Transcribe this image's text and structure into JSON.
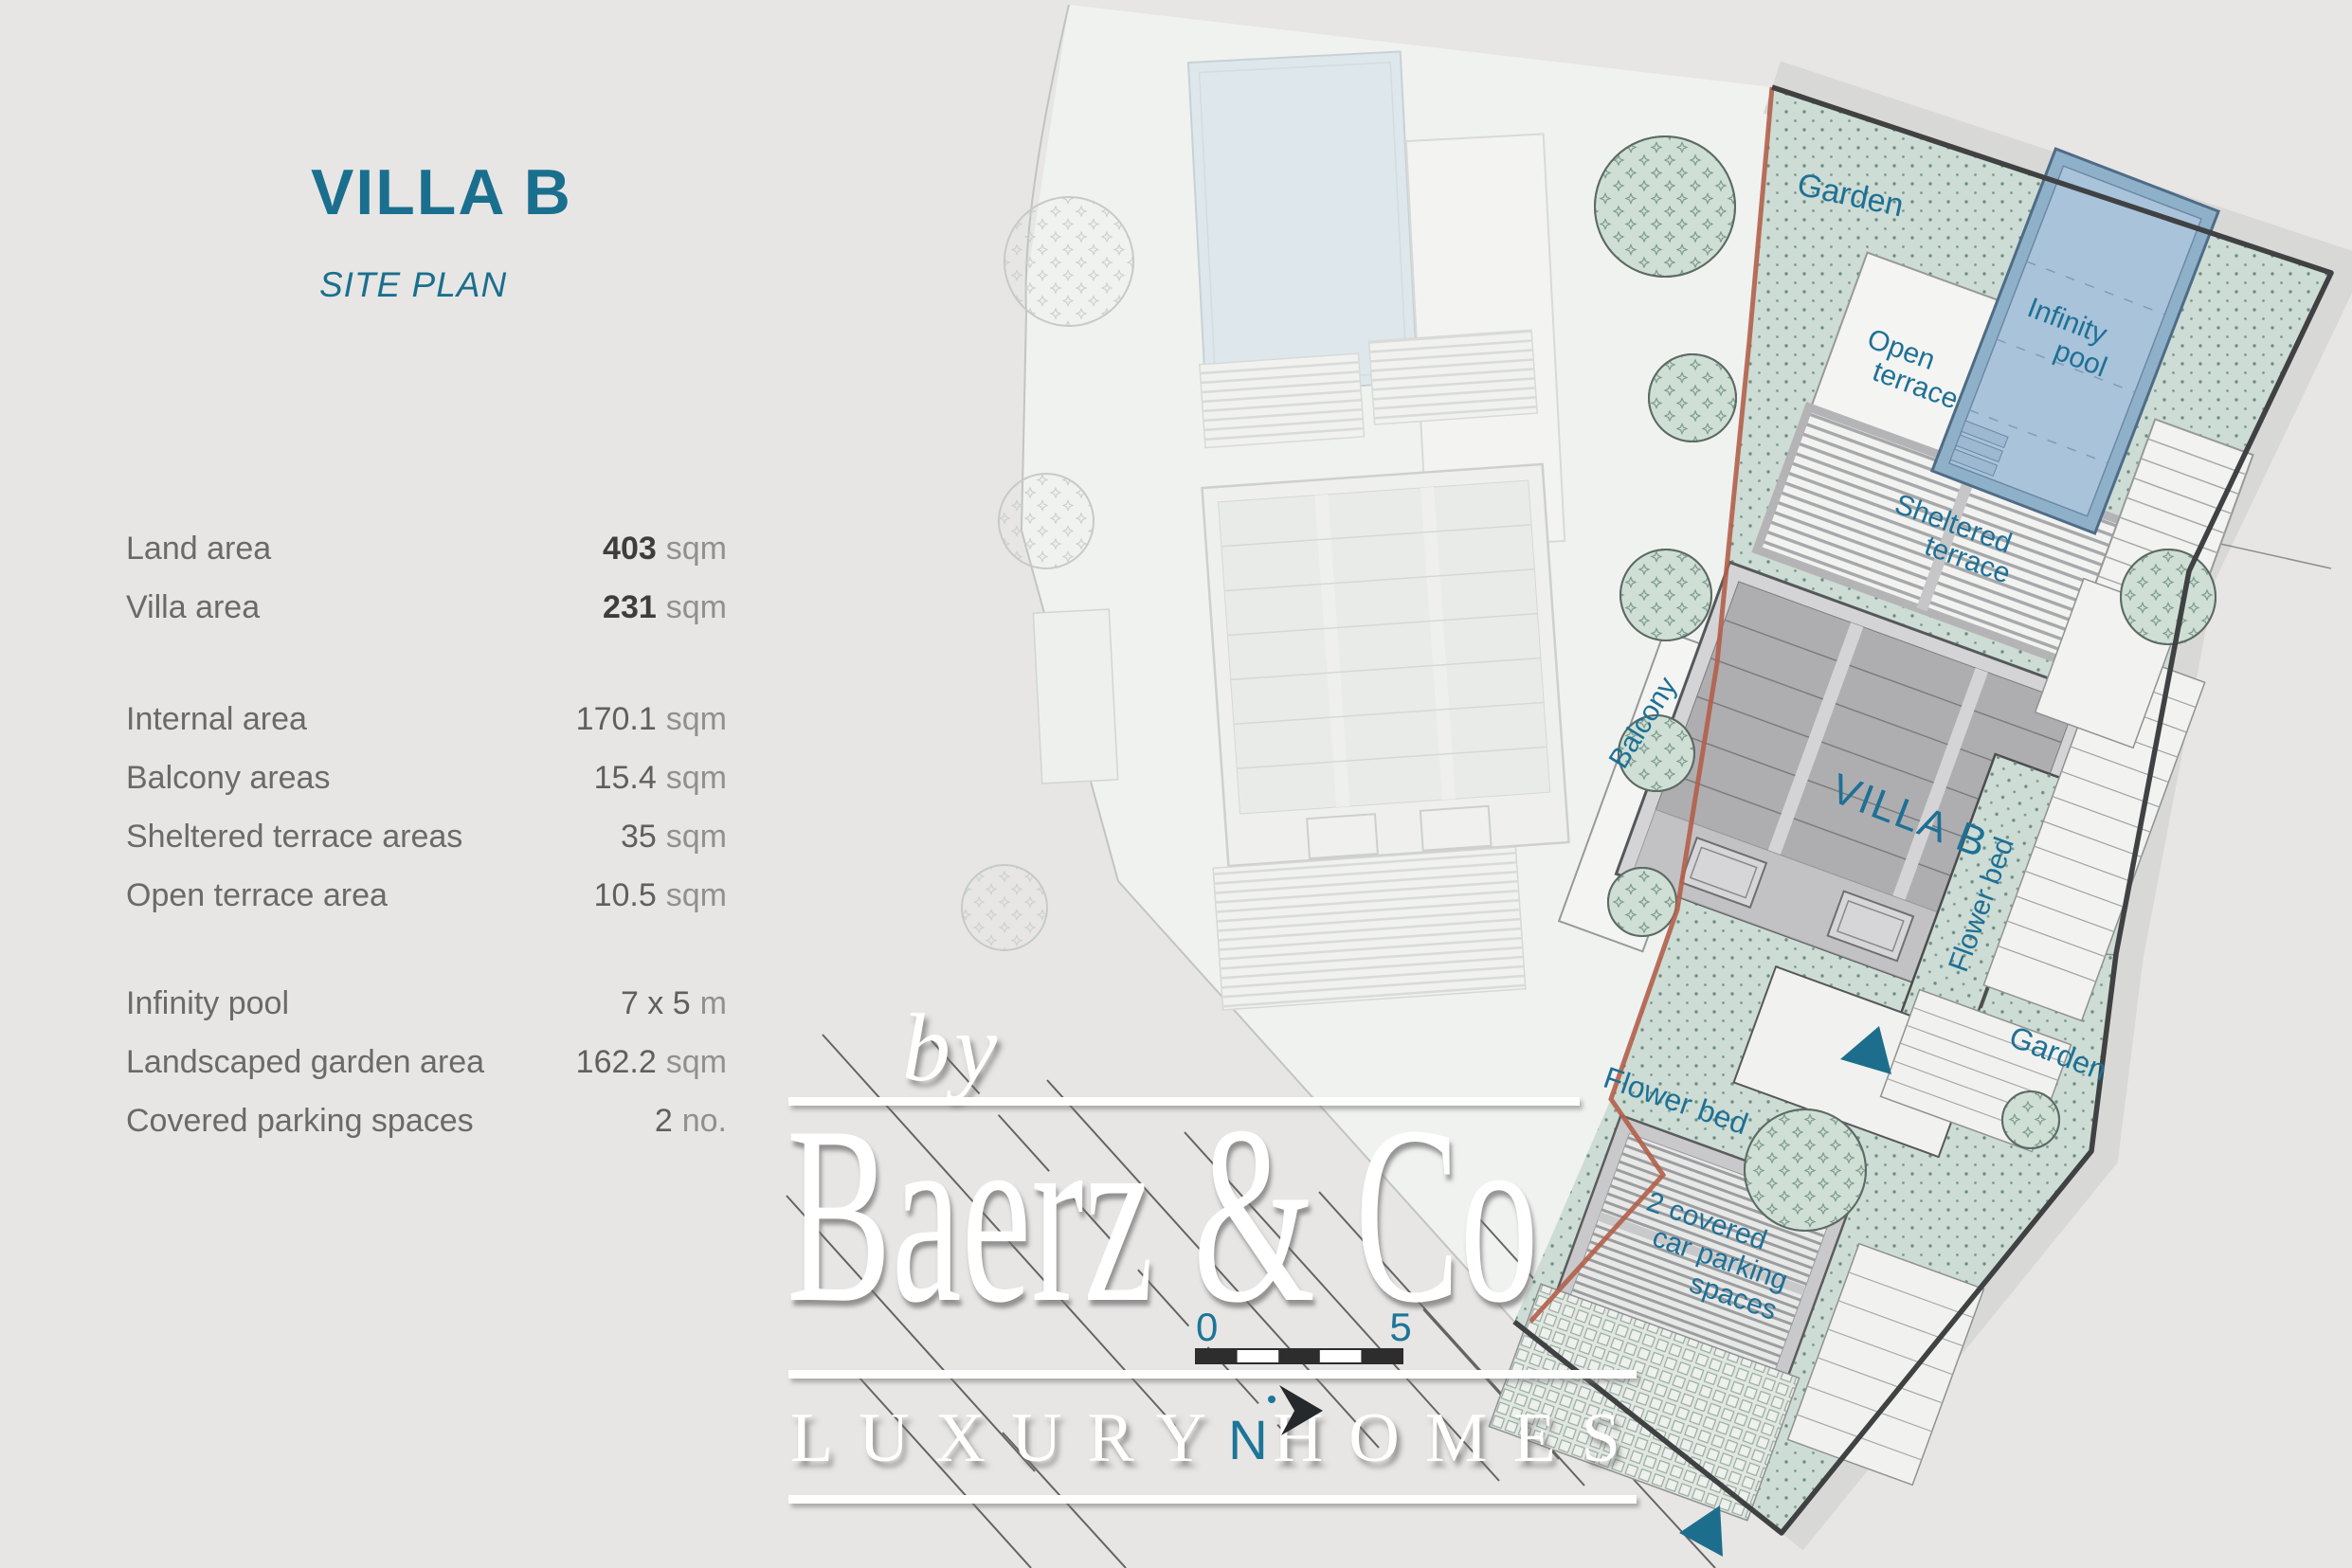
{
  "header": {
    "title": "VILLA B",
    "subtitle": "SITE PLAN"
  },
  "table": {
    "rows": [
      {
        "label": "Land area",
        "value": "403",
        "unit": "sqm",
        "emphasis": true
      },
      {
        "label": "Villa area",
        "value": "231",
        "unit": "sqm",
        "emphasis": true
      },
      {
        "label": "Internal area",
        "value": "170.1",
        "unit": "sqm",
        "emphasis": false
      },
      {
        "label": "Balcony areas",
        "value": "15.4",
        "unit": "sqm",
        "emphasis": false
      },
      {
        "label": "Sheltered terrace areas",
        "value": "35",
        "unit": "sqm",
        "emphasis": false
      },
      {
        "label": "Open terrace area",
        "value": "10.5",
        "unit": "sqm",
        "emphasis": false
      },
      {
        "label": "Infinity pool",
        "value": "7 x 5",
        "unit": "m",
        "emphasis": false
      },
      {
        "label": "Landscaped garden area",
        "value": "162.2",
        "unit": "sqm",
        "emphasis": false
      },
      {
        "label": "Covered parking spaces",
        "value": "2",
        "unit": "no.",
        "emphasis": false
      }
    ]
  },
  "plan": {
    "labels": {
      "garden_top": "Garden",
      "open_terrace": [
        "Open",
        "terrace"
      ],
      "infinity_pool": [
        "Infinity",
        "pool"
      ],
      "sheltered_terrace": [
        "Sheltered",
        "terrace"
      ],
      "balcony": "Balcony",
      "villa": "VILLA B",
      "flower_bed_right": "Flower bed",
      "flower_bed_left": "Flower bed",
      "garden_right": "Garden",
      "parking": [
        "2 covered",
        "car parking",
        "spaces"
      ]
    }
  },
  "scale_bar": {
    "start": "0",
    "end": "5"
  },
  "north": {
    "label": "N"
  },
  "watermark": {
    "prefix": "by",
    "brand": "Baerz & Co",
    "tagline": "LUXURY HOMES"
  },
  "colors": {
    "accent_teal": "#1a6f8e",
    "label_teal": "#1e7095",
    "garden_green": "#cddcd4",
    "pool_blue": "#a9c3da",
    "boundary_red": "#b35f4a",
    "boundary_dark": "#3f4143",
    "background": "#e7e6e4"
  }
}
